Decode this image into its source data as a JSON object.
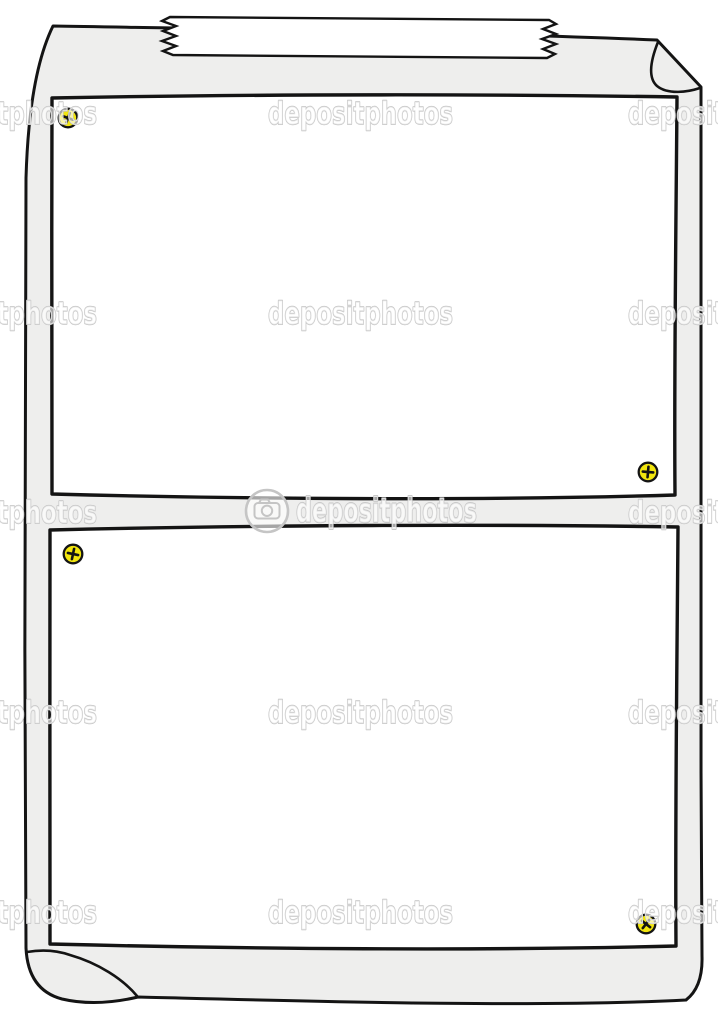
{
  "image": {
    "description": "Cartoon illustration of a blank gray paper sheet taped to a wall, with two blank white sign panels fastened by four yellow screws; corners of the sheet are curled at top-right and bottom-left",
    "background": "#ffffff"
  },
  "colors": {
    "paper": "#eeeeed",
    "panel": "#ffffff",
    "outline": "#141414",
    "tape": "#ffffff",
    "screw": "#f2e60e",
    "wm-stroke": "#c5c5c5",
    "wm-fill": "rgba(255,255,255,0.62)"
  },
  "watermark": {
    "word": "depositphotos",
    "logo_text": "depositphotos"
  },
  "illustration": {
    "panel_count": 2,
    "screw_count": 4,
    "tape_count": 1
  }
}
